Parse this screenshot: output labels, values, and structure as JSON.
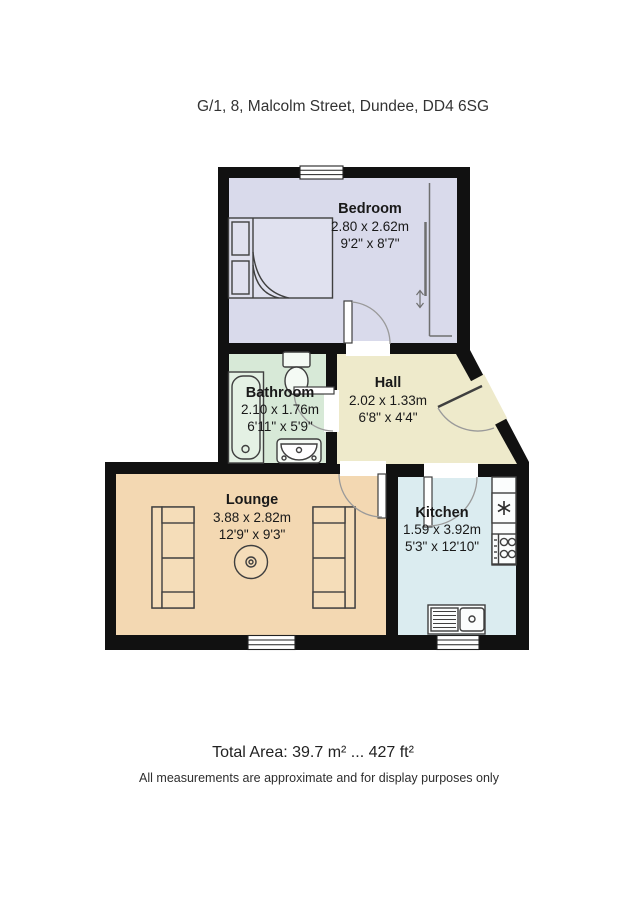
{
  "title": "G/1, 8, Malcolm Street, Dundee, DD4 6SG",
  "rooms": {
    "bedroom": {
      "name": "Bedroom",
      "metric": "2.80 x 2.62m",
      "imperial": "9'2\" x 8'7\""
    },
    "bathroom": {
      "name": "Bathroom",
      "metric": "2.10 x 1.76m",
      "imperial": "6'11\" x 5'9\""
    },
    "hall": {
      "name": "Hall",
      "metric": "2.02 x 1.33m",
      "imperial": "6'8\" x 4'4\""
    },
    "lounge": {
      "name": "Lounge",
      "metric": "3.88 x 2.82m",
      "imperial": "12'9\" x 9'3\""
    },
    "kitchen": {
      "name": "Kitchen",
      "metric": "1.59 x 3.92m",
      "imperial": "5'3\" x 12'10\""
    }
  },
  "footer": {
    "total_area": "Total Area: 39.7 m² ... 427 ft²",
    "disclaimer": "All measurements are approximate and for display purposes only"
  },
  "colors": {
    "wall": "#111111",
    "bedroom": "#d9daeb",
    "bathroom": "#d7e9d7",
    "hall": "#eeeacb",
    "lounge": "#f3d8b2",
    "kitchen": "#dbecf0"
  }
}
